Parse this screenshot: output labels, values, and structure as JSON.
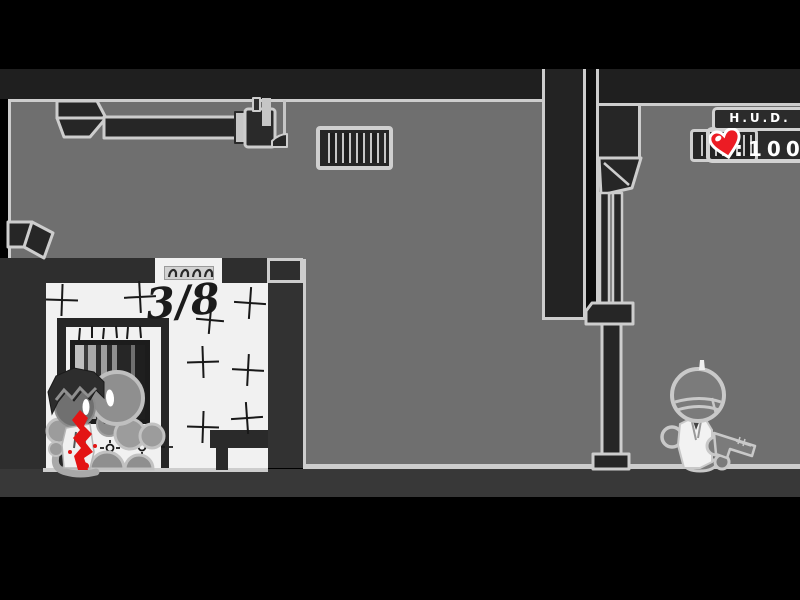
{
  "hud": {
    "title": "H.U.D.",
    "health_display": ":100",
    "heart_icon": "heart-icon",
    "heart_color": "#ec1c24"
  },
  "room": {
    "counter": "3/8"
  },
  "colors": {
    "background": "#000000",
    "wall_dark": "#2e2e2e",
    "floor_gray": "#6f6f6f",
    "outline_light": "#cdcdcd",
    "room_white": "#f1f1f1",
    "blood_red": "#e31414",
    "hud_text": "#ffffff"
  }
}
